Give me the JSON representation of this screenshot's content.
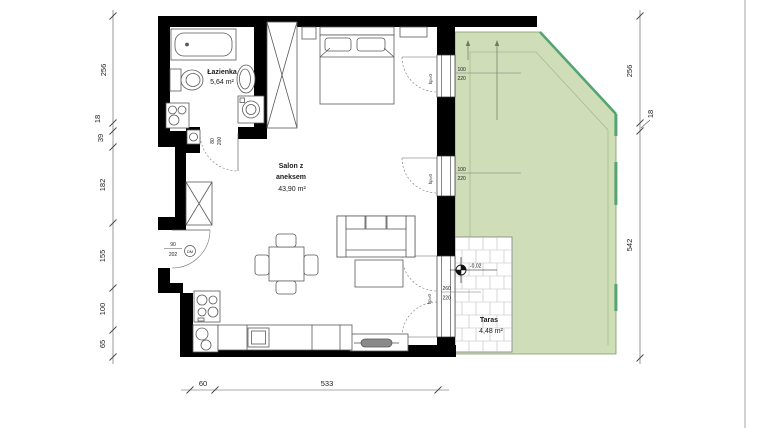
{
  "rooms": {
    "bathroom": {
      "name": "Łazienka",
      "area": "5,64 m²"
    },
    "living": {
      "name_line1": "Salon z",
      "name_line2": "aneksem",
      "area": "43,90 m²"
    },
    "terrace": {
      "name": "Taras",
      "area": "4,48 m²"
    }
  },
  "doors": {
    "entrance": {
      "width": "90",
      "height": "202",
      "tag": "DM"
    },
    "bathroom": {
      "width": "80",
      "height": "200"
    }
  },
  "windows": {
    "bedroom": {
      "width": "100",
      "height": "220",
      "sill": "hp=0"
    },
    "living": {
      "width": "100",
      "height": "220",
      "sill": "hp=0"
    },
    "terrace_door": {
      "width": "260",
      "height": "220",
      "sill": "hp=0"
    }
  },
  "terrace": {
    "level_label": "-0,02"
  },
  "dimensions": {
    "left": [
      "256",
      "18",
      "39",
      "182",
      "155",
      "100",
      "65"
    ],
    "right": [
      "256",
      "18",
      "542"
    ],
    "bottom": [
      "60",
      "533"
    ]
  },
  "colors": {
    "wall": "#000000",
    "lawn": "#cfdeb9",
    "lawn_border": "#7d9a5f",
    "lawn_accent": "#55a471",
    "tile_joint": "#bcbcbc",
    "furniture": "#5a5a5a",
    "dimension": "#444444"
  }
}
